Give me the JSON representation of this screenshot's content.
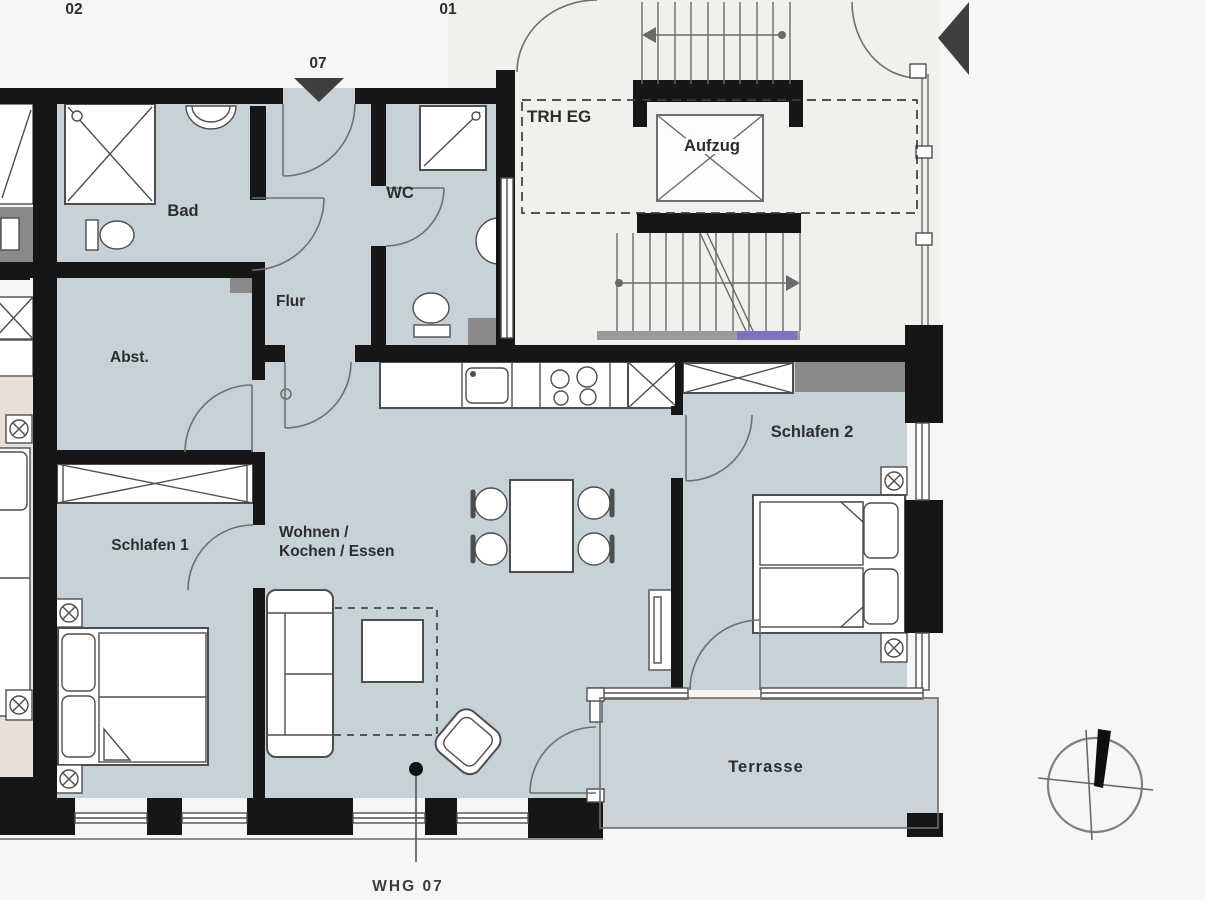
{
  "title": "Grundriss WHG 07",
  "units": {
    "left": "02",
    "right": "01"
  },
  "entrance": {
    "label": "07"
  },
  "stairwell": {
    "label": "TRH EG",
    "elevator_label": "Aufzug"
  },
  "rooms": {
    "bad": {
      "label": "Bad"
    },
    "wc": {
      "label": "WC"
    },
    "flur": {
      "label": "Flur"
    },
    "abstellraum": {
      "label": "Abst."
    },
    "schlafen1": {
      "label": "Schlafen 1"
    },
    "schlafen2": {
      "label": "Schlafen 2"
    },
    "wohnen_kochen_essen": {
      "label_line1": "Wohnen /",
      "label_line2": "Kochen / Essen"
    },
    "terrasse": {
      "label": "Terrasse"
    }
  },
  "annotations": {
    "apartment_tag": "WHG  07"
  },
  "colors": {
    "background": "#f7f6f4",
    "floor": "#c6d1d8",
    "terrace_floor": "#c9d3d9",
    "wall": "#161616",
    "stair_bg": "#f1f0ed",
    "fixture_gray": "#8a8a8a",
    "neighbor_floor": "#e9e1d7",
    "line": "#4e4e4e",
    "stair_tread_accent": "#7b73c0",
    "label_ink": "#2d2d2d"
  }
}
